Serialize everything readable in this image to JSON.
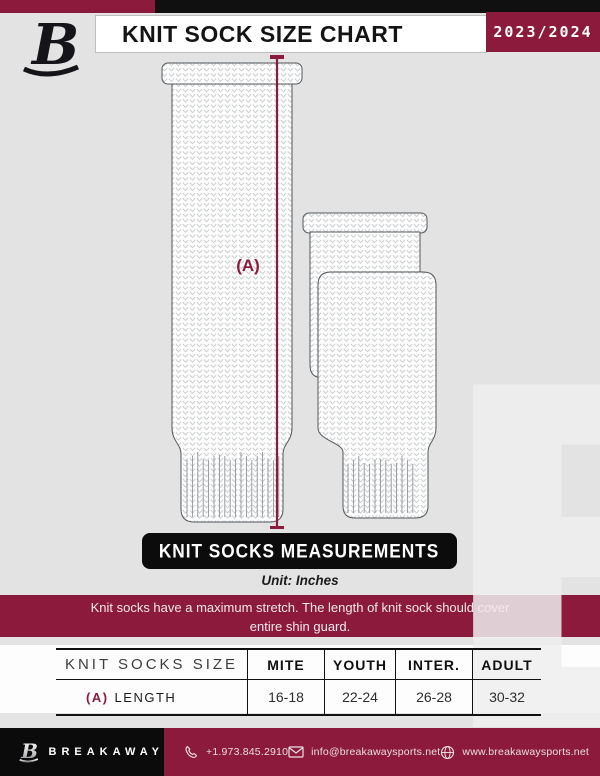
{
  "header": {
    "logo_letter": "B",
    "title": "KNIT SOCK SIZE CHART",
    "season": "2023/2024"
  },
  "diagram": {
    "label_a": "(A)"
  },
  "banner": {
    "title": "KNIT SOCKS MEASUREMENTS",
    "unit": "Unit: Inches"
  },
  "notice": {
    "line1": "Knit socks have a maximum stretch. The length of knit sock should cover",
    "line2": "entire shin guard."
  },
  "table": {
    "size_title": "KNIT SOCKS SIZE",
    "columns": [
      "MITE",
      "YOUTH",
      "INTER.",
      "ADULT"
    ],
    "rows": [
      {
        "label_prefix": "(A)",
        "label": "LENGTH",
        "values": [
          "16-18",
          "22-24",
          "26-28",
          "30-32"
        ]
      }
    ]
  },
  "footer": {
    "logo_letter": "B",
    "brand": "BREAKAWAY",
    "phone": "+1.973.845.2910",
    "email": "info@breakawaysports.net",
    "website": "www.breakawaysports.net"
  },
  "watermark_letter": "B",
  "colors": {
    "maroon": "#8C1A3C",
    "black": "#101010",
    "background_gray": "#E3E3E4",
    "white": "#FFFFFF"
  },
  "icons": {
    "phone": "phone-icon",
    "email": "envelope-icon",
    "website": "globe-icon",
    "logo": "b-monogram-icon"
  }
}
